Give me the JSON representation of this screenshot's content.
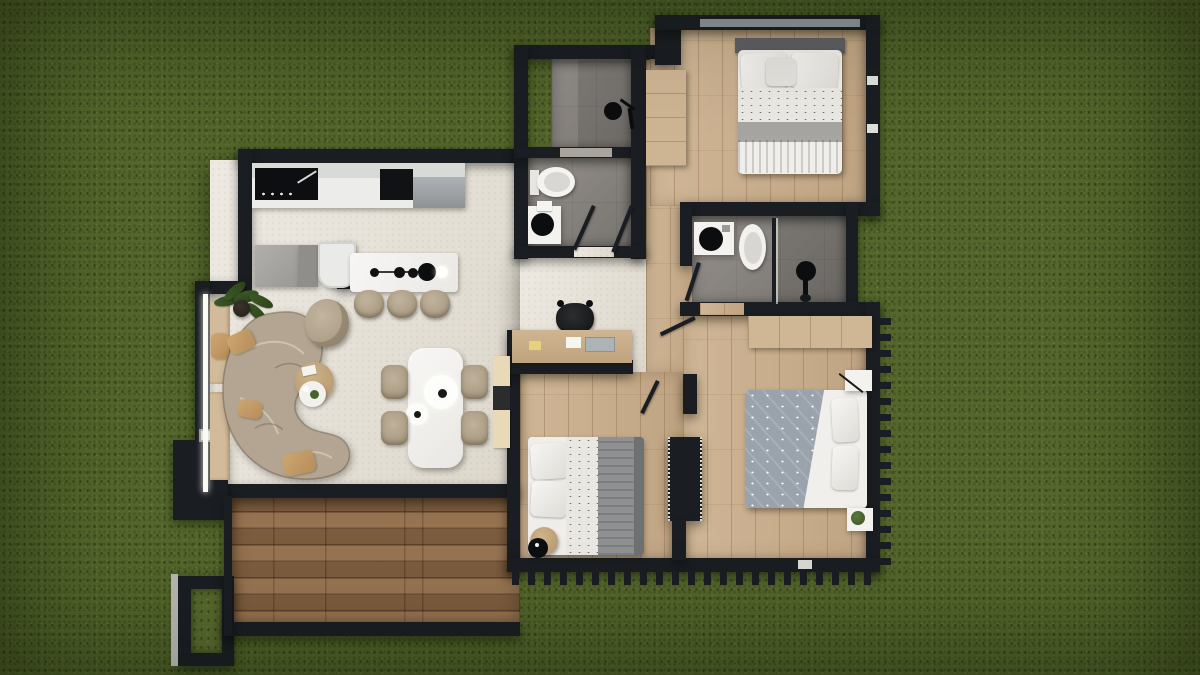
{
  "scene": {
    "type": "3d-rendered floor plan, top-down view",
    "surroundings": "grass lawn",
    "visible_text": "none"
  },
  "palette": {
    "grass": "#55672c",
    "wall": "#1a1e22",
    "cream": "#e7e2d8",
    "wood": "#c9ae8c",
    "deck": "#8a6847",
    "bath": "#8b8681",
    "white": "#f3f2ef",
    "sofa": "#b3a591",
    "tan": "#c9a06c",
    "wood-furniture": "#cdb493",
    "gray-blanket": "#8f9092",
    "duvet-gray": "#9aa2ac",
    "plant-green": "#3c5826"
  },
  "rooms": [
    {
      "name": "living-dining-kitchen",
      "floor": "cream tile"
    },
    {
      "name": "bedroom-top-right",
      "floor": "light wood"
    },
    {
      "name": "bedroom-bottom-middle",
      "floor": "light wood"
    },
    {
      "name": "bedroom-bottom-right",
      "floor": "light wood"
    },
    {
      "name": "bathroom-top-shower",
      "floor": "gray tile"
    },
    {
      "name": "bathroom-top-wc",
      "floor": "gray tile"
    },
    {
      "name": "bathroom-ensuite",
      "floor": "gray tile"
    },
    {
      "name": "hallway",
      "floor": "light wood"
    },
    {
      "name": "deck-patio",
      "floor": "dark wood planks"
    }
  ],
  "furniture": [
    "kitchen counter with black cooktop and black sink",
    "kitchen island with faucet and three bar stools",
    "fridge cabinets and white appliance",
    "curved organic beige sofa with tan pillows",
    "round beige pouf armchair",
    "round wooden coffee table with white tray",
    "potted plant",
    "window bench with cushion",
    "white dining table with two plates and four beige chairs",
    "media shelf unit",
    "desk with black chair, papers and laptop",
    "double bed top-right with white duvet and gray blankets",
    "single bed bottom-middle with gray blanket and round side table",
    "double bed bottom-right with gray patterned duvet and two white pillows",
    "two wardrobes",
    "two nightstands, one with green plant",
    "three showers/vanities with black round sinks, two toilets",
    "planter box and dark outdoor planter frame"
  ]
}
